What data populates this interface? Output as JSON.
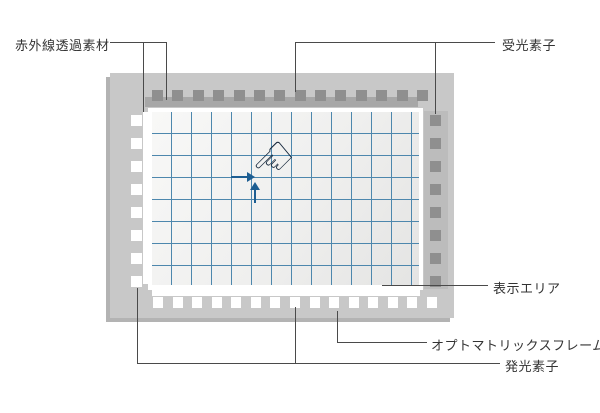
{
  "diagram": {
    "labels": {
      "ir_material": "赤外線透過素材",
      "receiver": "受光素子",
      "display_area": "表示エリア",
      "frame": "オプトマトリックスフレーム",
      "emitter": "発光素子"
    },
    "hand_icon_glyph": "☜",
    "counts": {
      "top_receivers": 14,
      "right_receivers": 8,
      "left_emitters": 8,
      "bottom_emitters": 15
    },
    "colors": {
      "frame": "#c8c8c8",
      "frame_shadow": "#b3b3b3",
      "receiver_square": "#8f8f8f",
      "emitter_square": "#ffffff",
      "material_bar_top": "#a7a7a7",
      "material_bar_right": "#bcbcbc",
      "material_bar_white": "#ffffff",
      "panel_border": "#ffffff",
      "grid_line": "#4d87ad",
      "arrow": "#1d5e92",
      "hand_outline": "#16283c",
      "leader_line": "#4a4a4a",
      "text": "#333333"
    }
  }
}
